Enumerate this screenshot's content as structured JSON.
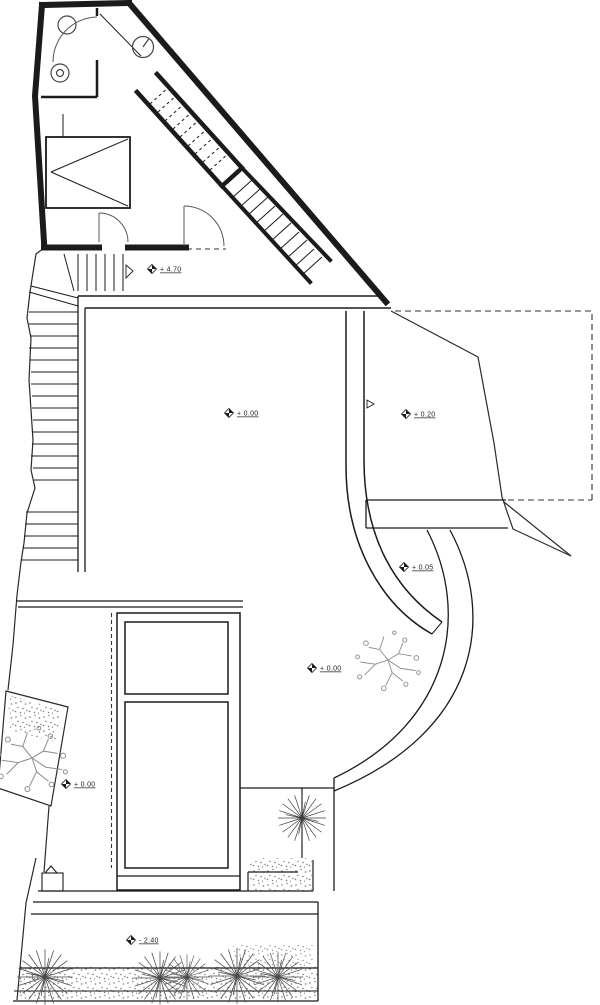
{
  "page": {
    "title": "Architectural floor and site plan",
    "background": "#ffffff"
  },
  "palette": {
    "wall_line": "#1b1b1b",
    "thin_line": "#2a2a2a",
    "door_arc": "#555555",
    "vegetation": "#8f8f8f",
    "palm": "#3c3c3c",
    "stipple": "#787878"
  },
  "plan": {
    "level_markers": [
      {
        "id": "entry-landing",
        "label": "+ 4.70"
      },
      {
        "id": "upper-terrace",
        "label": "+ 0.00"
      },
      {
        "id": "east-terrace",
        "label": "+ 0.20"
      },
      {
        "id": "curved-ramp",
        "label": "+ 0.05"
      },
      {
        "id": "lower-terrace",
        "label": "+ 0.00"
      },
      {
        "id": "west-planter",
        "label": "+ 0.00"
      },
      {
        "id": "street-level",
        "label": "- 2.40"
      }
    ]
  }
}
